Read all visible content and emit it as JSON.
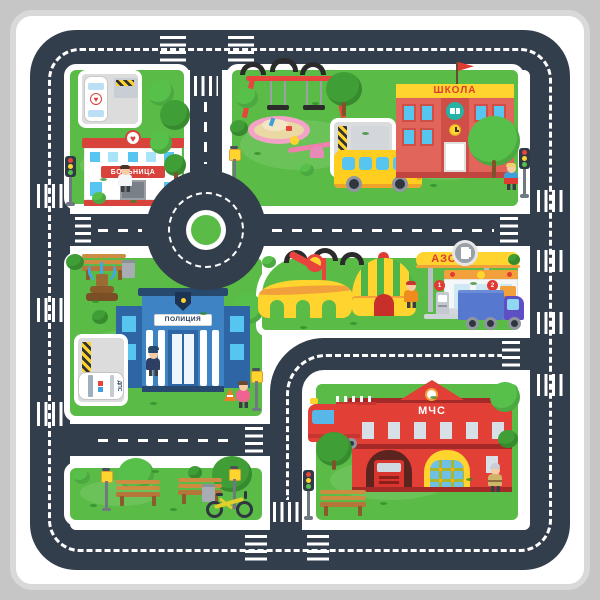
{
  "signs": {
    "hospital": "БОЛЬНИЦА",
    "school": "ШКОЛА",
    "police": "ПОЛИЦИЯ",
    "gas_station": "АЗС",
    "fire_station": "МЧС",
    "police_car": "ДПС",
    "gas_pump_1": "1",
    "gas_pump_2": "2"
  },
  "colors": {
    "road": "#333e4c",
    "grass": "#5bbb47",
    "mat": "#ffffff",
    "frame": "#c6c6c6",
    "accent-red": "#e03b33",
    "accent-yellow": "#ffd42e",
    "police-blue": "#3e83c4",
    "cyan-window": "#56c5ef",
    "school-wall": "#e2655c",
    "fire-red": "#e23f37",
    "tree-light": "#57c04a",
    "tree-dark": "#3f9e35"
  }
}
